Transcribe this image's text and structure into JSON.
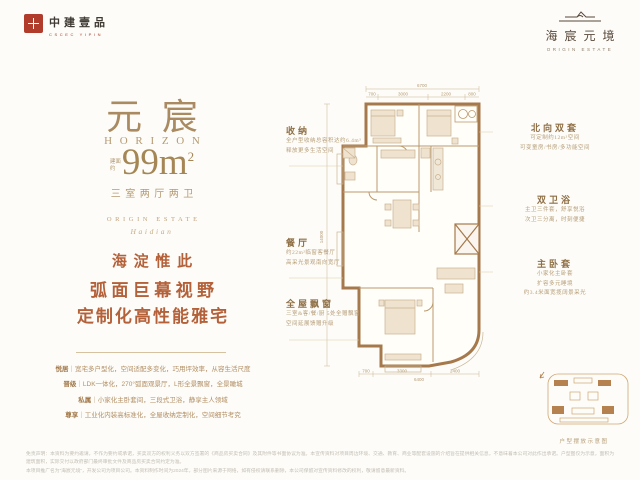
{
  "header": {
    "brand_left": {
      "name": "中建壹品",
      "sub": "CSCEC YIPIN"
    },
    "brand_right": {
      "name": "海宸元境",
      "sub": "ORIGIN ESTATE"
    }
  },
  "left_panel": {
    "title": "元宸",
    "subtitle": "HORIZON",
    "area_prefix": "建面约",
    "area_value": "99m",
    "area_sup": "2",
    "layout": "三室两厅两卫",
    "estate_caps": "ORIGIN ESTATE",
    "estate_script": "Haidian",
    "slogans": [
      "海淀惟此",
      "弧面巨幕视野",
      "定制化高性能雅宅"
    ],
    "features": [
      {
        "label": "悦居",
        "text": "｜宽宅多户型化，空间适配多变化，巧用坪效率，从容生活尺度"
      },
      {
        "label": "晋级",
        "text": "｜LDK一体化，270°弧面观景厅，L形全景飘窗，全景瞰城"
      },
      {
        "label": "私属",
        "text": "｜小家化主卧套间，三段式卫浴，静享主人领域"
      },
      {
        "label": "尊享",
        "text": "｜工业化内装高标准化，全屋收纳定制化，空间细节考究"
      }
    ]
  },
  "plan": {
    "dims": {
      "top_total": "6700",
      "top_segments": [
        "700",
        "3000",
        "2200",
        "800"
      ],
      "bottom_segments": [
        "700",
        "3300",
        "2400"
      ],
      "bottom_total": "6400",
      "left_total": "14000"
    },
    "annotations_left": [
      {
        "title": "收纳",
        "line1": "全户型收纳总容积达约6.4m³",
        "line2": "释放更多生活空间"
      },
      {
        "title": "餐厅",
        "line1": "约22m²临窗客餐厅",
        "line2": "高采光景观南向宽厅"
      },
      {
        "title": "全屋飘窗",
        "line1": "三室&客/餐/厨 5处全赠飘窗",
        "line2": "空间延展馈赠升级"
      }
    ],
    "annotations_right": [
      {
        "title": "北向双套",
        "line1": "可定制约12m²空间",
        "line2": "可变童房/书房/多功能空间"
      },
      {
        "title": "双卫浴",
        "line1": "主卫三件套，舒享悦浴",
        "line2": "次卫三分离，时刻便捷"
      },
      {
        "title": "主卧套",
        "line1": "小家化主卧套",
        "line2": "扩容多元睡境",
        "line3": "约3.4米面宽揽阔景采光"
      }
    ],
    "keyplan_caption": "户型摆放示意图"
  },
  "footer": {
    "line1": "免责声明：本资料为要约邀请，不作为要约或承诺，买卖双方的权利义务以双方签署的《商品房买卖合同》及其附件等书面协议为准。本宣传资料对项目周边环境、交通、教育、商业等配套设施的介绍旨在提供相关信息，不意味着本公司对此作出承诺。户型图仅为示意，面积为建筑面积，实际交付以政府部门最终审批文件及商品房买卖合同约定为准。",
    "line2": "本项目推广名为“海宸元境”，开发公司为项目公司。本资料制作时间为2024年，部分图片来源于网络，如有侵权请联系删除，本公司保留对宣传资料修改的权利，敬请留意最新资料。"
  }
}
